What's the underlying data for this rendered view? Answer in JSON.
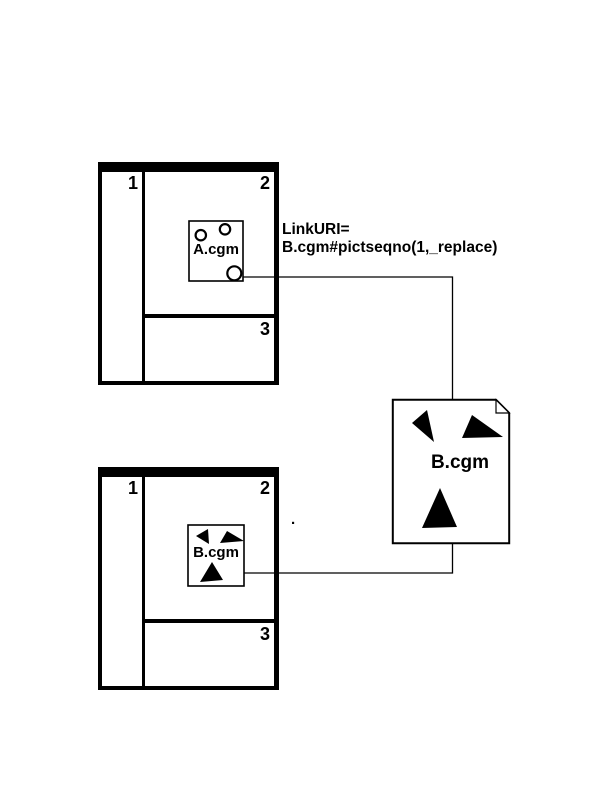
{
  "colors": {
    "ink": "#000000",
    "paper": "#ffffff"
  },
  "top_picture": {
    "region_labels": {
      "r1": "1",
      "r2": "2",
      "r3": "3"
    },
    "embedded_object": {
      "label": "A.cgm"
    }
  },
  "bottom_picture": {
    "region_labels": {
      "r1": "1",
      "r2": "2",
      "r3": "3"
    },
    "embedded_object": {
      "label": "B.cgm"
    }
  },
  "link_annotation": {
    "line1": "LinkURI=",
    "line2": "B.cgm#pictseqno(1,_replace)"
  },
  "document_icon": {
    "label": "B.cgm"
  },
  "stray_dot": "."
}
